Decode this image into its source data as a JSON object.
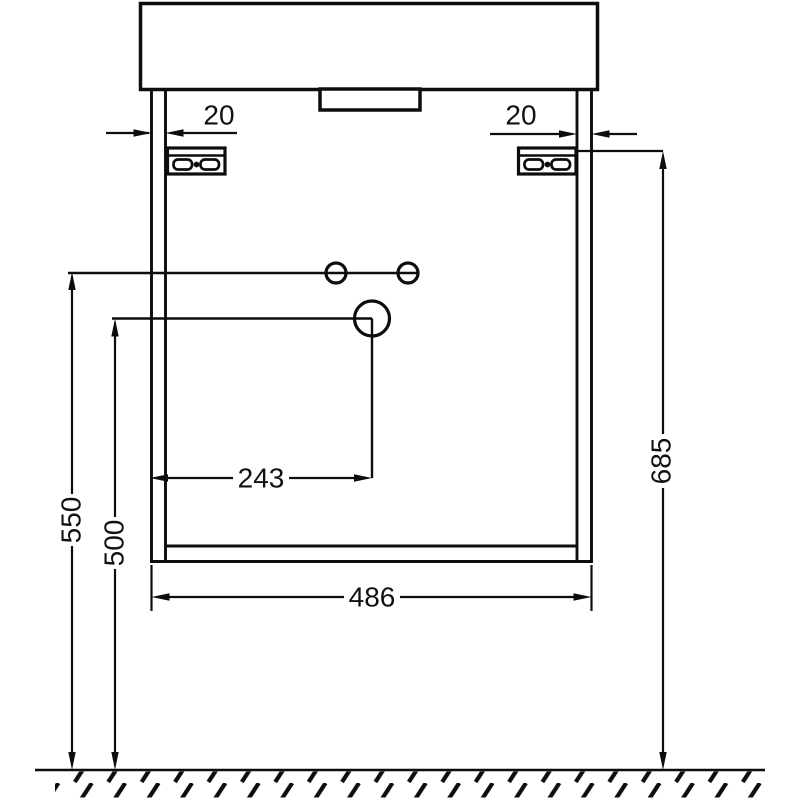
{
  "drawing": {
    "background_color": "#ffffff",
    "line_color": "#0d0d0d",
    "dimensions": {
      "left_panel_thickness": "20",
      "right_panel_thickness": "20",
      "drain_offset_from_left": "243",
      "cabinet_width": "486",
      "upper_holes_height": "550",
      "drain_height": "500",
      "bracket_height": "685"
    }
  }
}
